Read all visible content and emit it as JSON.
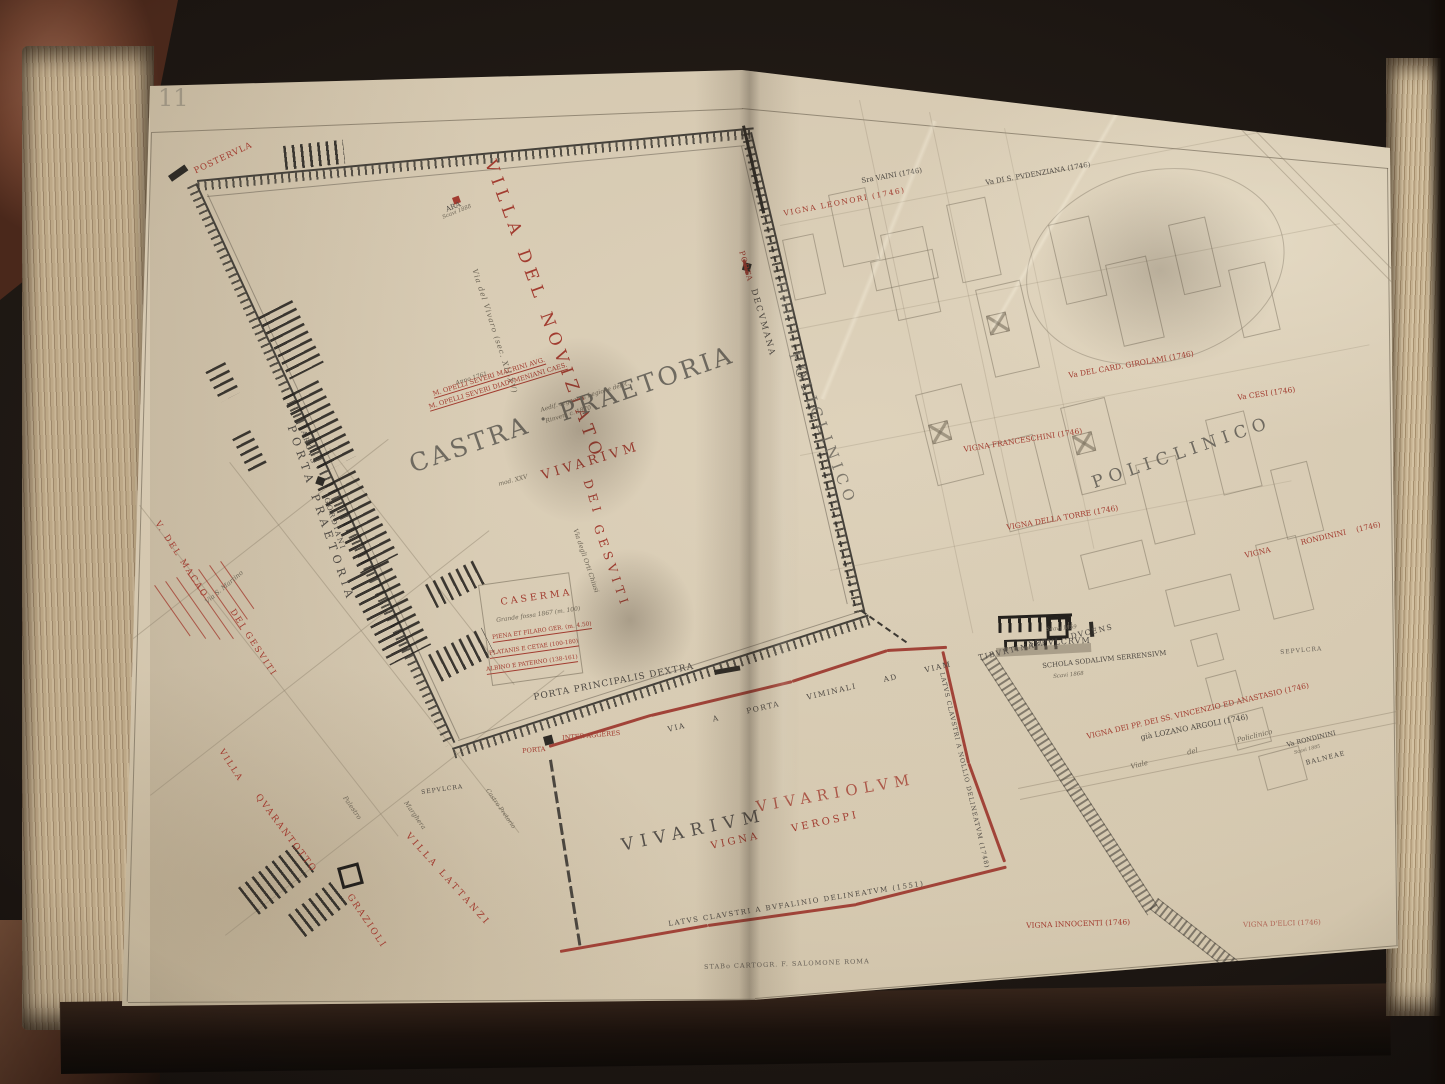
{
  "plate": {
    "number": "11",
    "imprint": "STABo CARTOGR. F. SALOMONE ROMA"
  },
  "colors": {
    "paper": "#d5c8b0",
    "label_red": "#a23c30",
    "label_dark": "#4e4943",
    "title_gray": "#6f6a60",
    "wall_red": "#9c372e"
  },
  "labels": {
    "posterula": "POSTERVLA",
    "ara": "ARA",
    "ara_note": "Scavi 1888",
    "villa_noviziato": "VILLA DEL NOVIZIATO",
    "via_vivaro": "Via del Vivaro (sec. XII-XV)",
    "anno": "Anno 1761",
    "opelli_1": "M. OPELLI SEVERI MACRINI AVG.",
    "opelli_2": "M. OPELLI SEVERI DIADVMENIANI CAES.",
    "castra": "CASTRA · PRAETORIA",
    "castra_note1": "Aedif. segnat. a Legione delet.",
    "castra_note2": "Rinven. c. 1870",
    "mod_note": "mod. XXV",
    "vivarium_red": "VIVARIVM",
    "dei": "DEI",
    "gesuiti": "GESVITI",
    "orti": "Via degli Orti Chiusi",
    "caserma": "CASERMA",
    "caserma_note": "Grande fossa 1867 (m. 100)",
    "caserma_l1": "PIENA ET FILARO GER. (m. 4.50)",
    "caserma_l2": "PLATANIS E CETAE (100-180)",
    "caserma_l3": "ALBINO E PATERNO (138-161)",
    "porta_praetoria": "PORTA PRAETORIA",
    "arcus": "ARCVS",
    "gordiani": "GORDIANI",
    "porta_red": "PORTA",
    "decumana": "DECVMANA",
    "policlinico_vert": "POLICLINICO",
    "policlinico_big": "POLICLINICO",
    "vigna_leonori": "VIGNA LEONORI (1746)",
    "vaini": "Sra VAINI (1746)",
    "pudenziana": "Va DI S. PVDENZIANA (1746)",
    "girolami": "Va DEL CARD. GIROLAMI (1746)",
    "cesi": "Va CESI (1746)",
    "franceschini": "VIGNA FRANCESCHINI (1746)",
    "della_torre": "VIGNA DELLA TORRE (1746)",
    "vigna_rondinini": "VIGNA   RONDININI (1746)",
    "sepulcrum": "SEPVLCRVM",
    "scavi_1859": "Scavi 1859",
    "schola": "SCHOLA SODALIVM SERRENSIVM",
    "schola_note": "Scavi 1868",
    "sepolcra_right": "SEPVLCRA",
    "vincenzio": "VIGNA DEI PP. DEI SS. VINCENZIO ED ANASTASIO (1746)",
    "lozano": "già LOZANO ARGOLI (1746)",
    "viale_policlinico": "Viale  del  Policlinico",
    "va_rondinini": "Va RONDININI",
    "rondinini_note": "Scavi 1885",
    "balneae": "BALNEAE",
    "vivarium_big": "VIVARIVM",
    "vivariolum": "VIVARIOLVM",
    "verospi": "VIGNA  VEROSPI",
    "latus_bufalinio": "LATVS CLAVSTRI A BVFALINIO DELINEATVM (1551)",
    "latus_nollio": "LATVS CLAVSTRI A NOLLIO DELINEATVM (1748)",
    "vigna_innocenti": "VIGNA INNOCENTI (1746)",
    "vigna_elci": "VIGNA D'ELCI (1746)",
    "porta_principalis": "PORTA PRINCIPALIS DEXTRA",
    "via_tiburtina": "VIA  A  PORTA  VIMINALI  AD  VIAM  TIBVRTINAM  DVCENS",
    "porta_red2": "PORTA",
    "inter_aggeres": "INTER AGGERES",
    "macao": "V. DEL MACAO",
    "dei_gesuiti2": "DEI GESVITI",
    "villa_red": "VILLA",
    "quarantotto": "QVARANTOTTO",
    "villa_lattanzi": "VILLA LATTANZI",
    "grazioli": "GRAZIOLI",
    "via_s_martino": "Via S. Martino",
    "palestro": "Palestro",
    "margherita": "Marghera",
    "sepulcra": "SEPVLCRA",
    "castro": "Castro Pretorio"
  }
}
